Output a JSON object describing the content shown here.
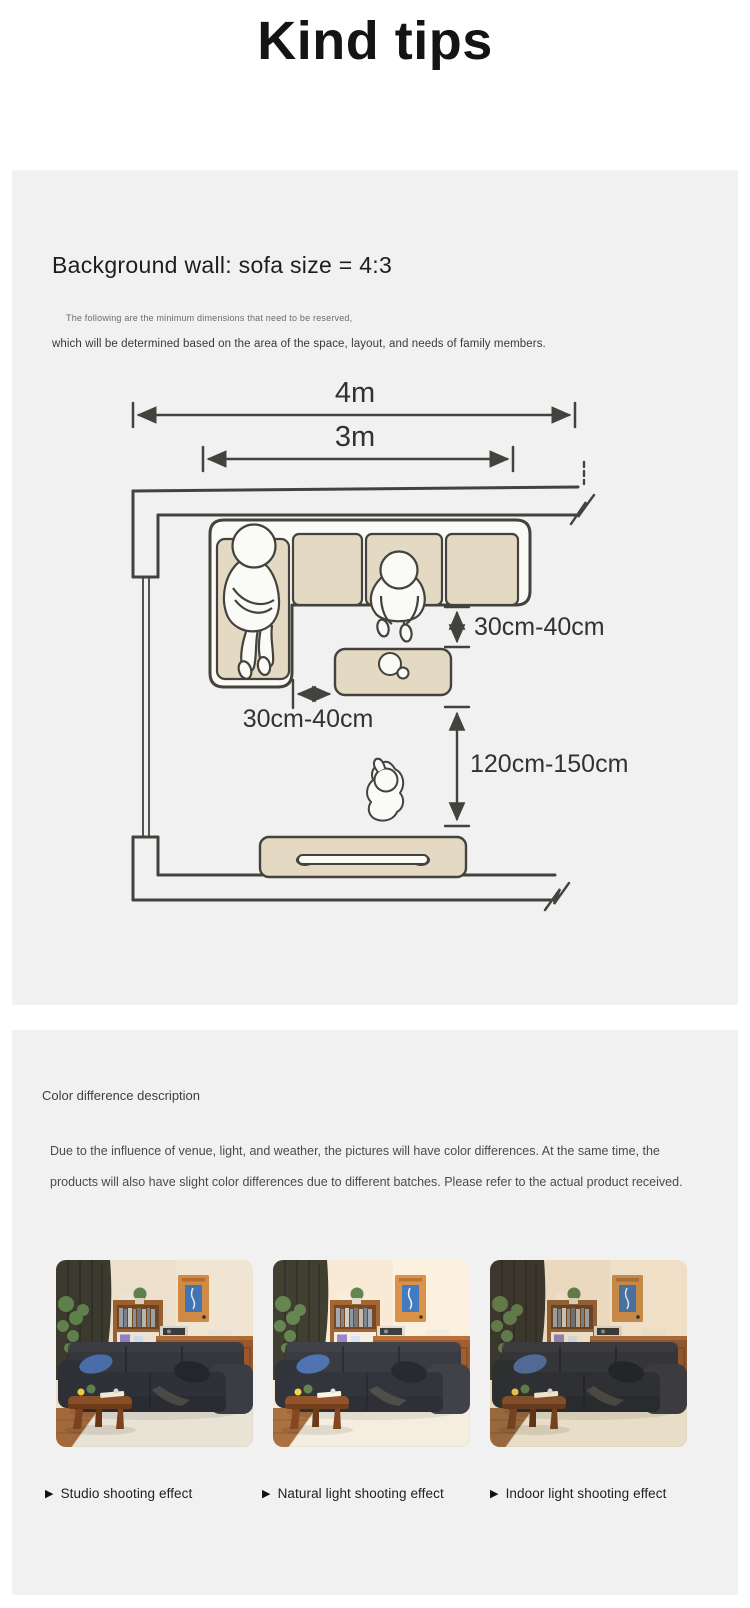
{
  "page": {
    "title": "Kind tips"
  },
  "size_panel": {
    "heading": "Background wall: sofa size = 4:3",
    "note_small": "The following are the minimum dimensions that need to be reserved,",
    "note": "which will be determined based on the area of the space, layout, and needs of family members.",
    "diagram": {
      "dim_room_width": "4m",
      "dim_sofa_wall_width": "3m",
      "dim_sofa_to_table_vertical": "30cm-40cm",
      "dim_sofa_to_table_horizontal": "30cm-40cm",
      "dim_table_to_tv": "120cm-150cm"
    }
  },
  "color_panel": {
    "heading": "Color difference description",
    "body": "Due to the influence of venue, light, and weather, the pictures will have color differences. At the same time, the products will also have slight color differences due to different batches. Please refer to the actual product received.",
    "caption_marker": "▶",
    "photos": [
      {
        "caption": "Studio shooting effect"
      },
      {
        "caption": "Natural light shooting effect"
      },
      {
        "caption": "Indoor light shooting effect"
      }
    ]
  },
  "colors": {
    "panel_bg": "#f1f1f2",
    "diagram_fill": "#e4dac3",
    "diagram_line": "#44423d"
  }
}
